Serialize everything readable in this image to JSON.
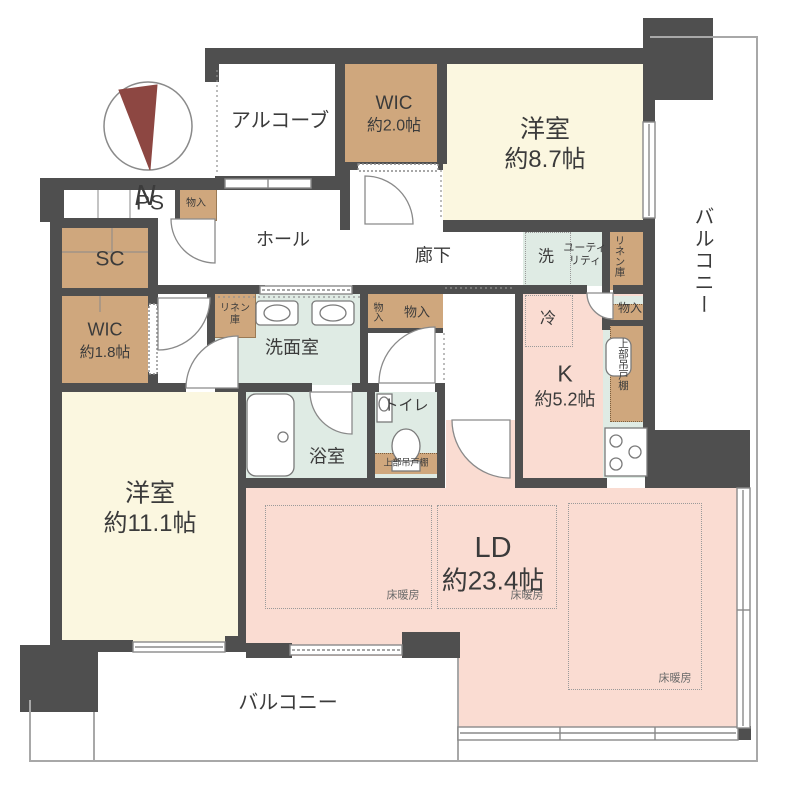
{
  "plan": {
    "compass_label": "N",
    "colors": {
      "wall": "#4f4f4f",
      "cream": "#fbf7e0",
      "pink": "#fadcd2",
      "mint": "#dfebe4",
      "tan": "#cfa77d",
      "needle": "#8d4742",
      "line": "#8a8a8a",
      "outline": "#a8a8a8",
      "text": "#3b3b3b"
    },
    "rooms": {
      "alcove": {
        "name": "アルコーブ"
      },
      "wic_upper": {
        "name": "WIC",
        "size": "約2.0帖"
      },
      "bedroom_87": {
        "name": "洋室",
        "size": "約8.7帖"
      },
      "balcony_right": {
        "name": "バルコニー"
      },
      "ps": {
        "name": "PS"
      },
      "storage_entrance": {
        "name": "物入"
      },
      "sc": {
        "name": "SC"
      },
      "wic_lower": {
        "name": "WIC",
        "size": "約1.8帖"
      },
      "hall": {
        "name": "ホール"
      },
      "corridor": {
        "name": "廊下"
      },
      "washer": {
        "name": "洗"
      },
      "utility": {
        "name": "ユーティリティ"
      },
      "linen_upper": {
        "name": "リネン庫"
      },
      "linen_washroom": {
        "name": "リネン庫"
      },
      "storage_hall_small": {
        "name": "物入"
      },
      "storage_hall": {
        "name": "物入"
      },
      "storage_kitchen": {
        "name": "物入"
      },
      "fridge": {
        "name": "冷"
      },
      "kitchen": {
        "name": "K",
        "size": "約5.2帖"
      },
      "hanging_cabinet_kitchen": {
        "name": "上部吊戸棚"
      },
      "washroom": {
        "name": "洗面室"
      },
      "bathroom": {
        "name": "浴室"
      },
      "toilet": {
        "name": "トイレ"
      },
      "hanging_cabinet_toilet": {
        "name": "上部吊戸棚"
      },
      "bedroom_111": {
        "name": "洋室",
        "size": "約11.1帖"
      },
      "living_dining": {
        "name": "LD",
        "size": "約23.4帖"
      },
      "floor_heating_1": {
        "name": "床暖房"
      },
      "floor_heating_2": {
        "name": "床暖房"
      },
      "floor_heating_3": {
        "name": "床暖房"
      },
      "balcony_bottom": {
        "name": "バルコニー"
      }
    }
  }
}
